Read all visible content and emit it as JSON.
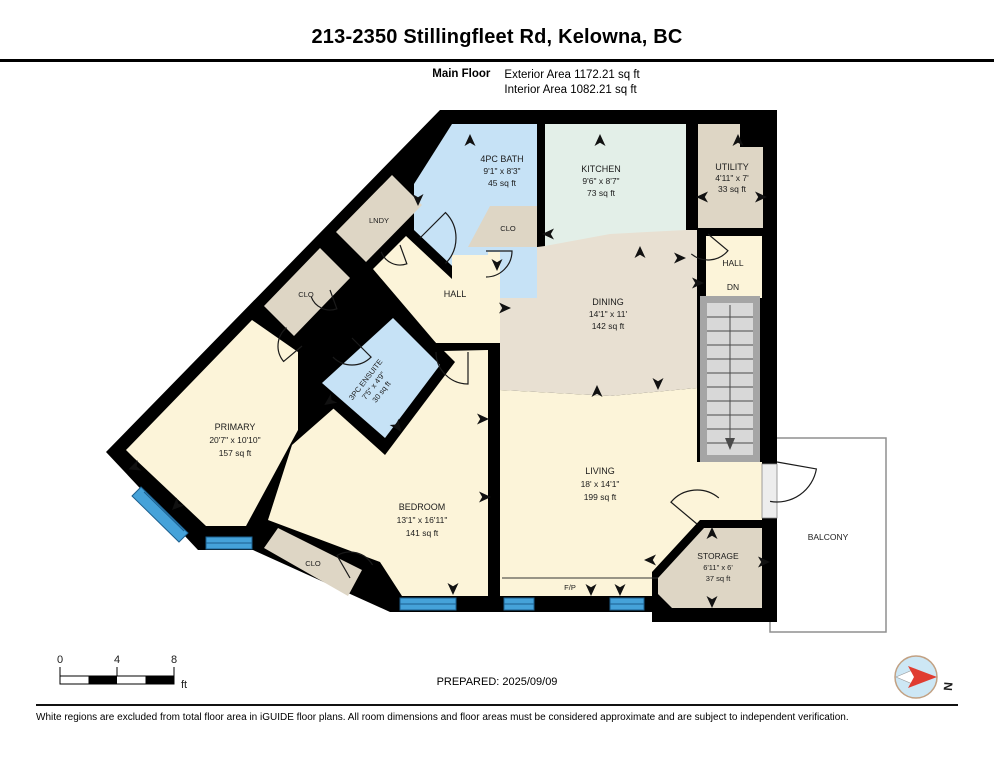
{
  "header": {
    "title": "213-2350 Stillingfleet Rd, Kelowna, BC",
    "floor_label": "Main Floor",
    "exterior_area": "Exterior Area 1172.21 sq ft",
    "interior_area": "Interior Area 1082.21 sq ft"
  },
  "rooms": {
    "bath": {
      "name": "4PC BATH",
      "dims": "9'1\" x 8'3\"",
      "area": "45 sq ft"
    },
    "kitchen": {
      "name": "KITCHEN",
      "dims": "9'6\" x 8'7\"",
      "area": "73 sq ft"
    },
    "utility": {
      "name": "UTILITY",
      "dims": "4'11\" x 7'",
      "area": "33 sq ft"
    },
    "dining": {
      "name": "DINING",
      "dims": "14'1\" x 11'",
      "area": "142 sq ft"
    },
    "ensuite": {
      "name": "3PC ENSUITE",
      "dims": "7'5\" x 4'9\"",
      "area": "30 sq ft"
    },
    "primary": {
      "name": "PRIMARY",
      "dims": "20'7\" x 10'10\"",
      "area": "157 sq ft"
    },
    "bedroom": {
      "name": "BEDROOM",
      "dims": "13'1\" x 16'11\"",
      "area": "141 sq ft"
    },
    "living": {
      "name": "LIVING",
      "dims": "18' x 14'1\"",
      "area": "199 sq ft"
    },
    "storage": {
      "name": "STORAGE",
      "dims": "6'11\" x 6'",
      "area": "37 sq ft"
    },
    "hall": {
      "name": "HALL"
    },
    "upper_hall": {
      "name": "HALL",
      "dn": "DN"
    },
    "lndy": {
      "name": "LNDY"
    },
    "clo_kitchen": {
      "name": "CLO"
    },
    "clo_diag": {
      "name": "CLO"
    },
    "clo_bedroom": {
      "name": "CLO"
    },
    "fireplace": {
      "name": "F/P"
    },
    "balcony": {
      "name": "BALCONY"
    }
  },
  "scale_bar": {
    "tick0": "0",
    "tick4": "4",
    "tick8": "8",
    "unit": "ft"
  },
  "compass": {
    "label": "N"
  },
  "footer": {
    "prepared": "PREPARED: 2025/09/09",
    "disclaimer": "White regions are excluded from total floor area in iGUIDE floor plans. All room dimensions and floor areas must be considered approximate and are subject to independent verification."
  },
  "colors": {
    "wall": "#000000",
    "room_cream": "#fcf4d9",
    "room_tan": "#ded6c5",
    "room_tan_light": "#e8e0d2",
    "room_blue": "#c6e2f6",
    "room_green": "#e3efe8",
    "window_blue": "#45a2d9",
    "stair_gray": "#d8d8d8",
    "stair_frame": "#a5a5a5",
    "compass_red": "#e03c31"
  }
}
